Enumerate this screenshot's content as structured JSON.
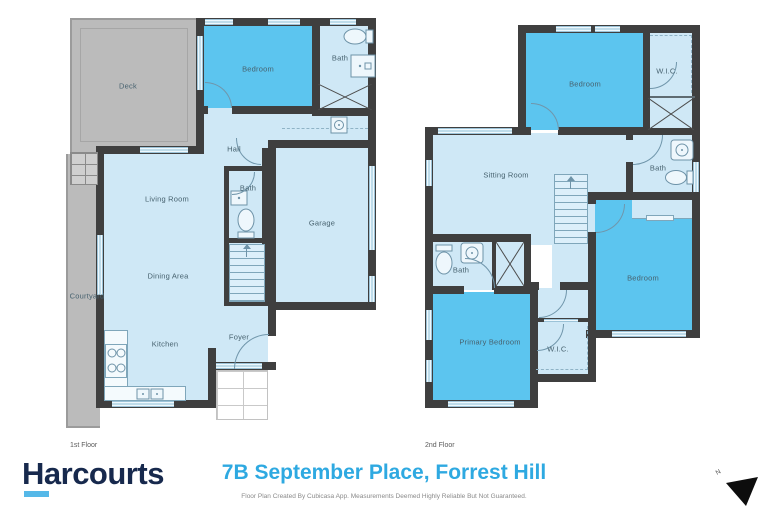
{
  "colors": {
    "wall": "#3F3F3F",
    "room_light": "#CFE8F6",
    "room_medium": "#5CC5EF",
    "outdoor_gray": "#BBBBBB",
    "title_blue": "#2EA9E1",
    "brand_navy": "#17294D",
    "brand_underline_blue": "#55B8E8"
  },
  "floors": {
    "first": {
      "label": "1st Floor",
      "rooms": {
        "deck": "Deck",
        "bedroom": "Bedroom",
        "bath_top": "Bath",
        "hall": "Hall",
        "living_room": "Living Room",
        "bath_mid": "Bath",
        "garage": "Garage",
        "dining_area": "Dining Area",
        "courtyard": "Courtyard",
        "kitchen": "Kitchen",
        "foyer": "Foyer"
      }
    },
    "second": {
      "label": "2nd Floor",
      "rooms": {
        "bedroom_top": "Bedroom",
        "wic_top": "W.I.C.",
        "sitting_room": "Sitting Room",
        "bath_right": "Bath",
        "bath_mid": "Bath",
        "primary_bedroom": "Primary Bedroom",
        "wic_bottom": "W.I.C.",
        "bedroom_right": "Bedroom"
      }
    }
  },
  "footer": {
    "brand": "Harcourts",
    "title": "7B September Place, Forrest Hill",
    "disclaimer": "Floor Plan Created By Cubicasa App. Measurements Deemed Highly Reliable But Not Guaranteed.",
    "compass_label": "N"
  }
}
